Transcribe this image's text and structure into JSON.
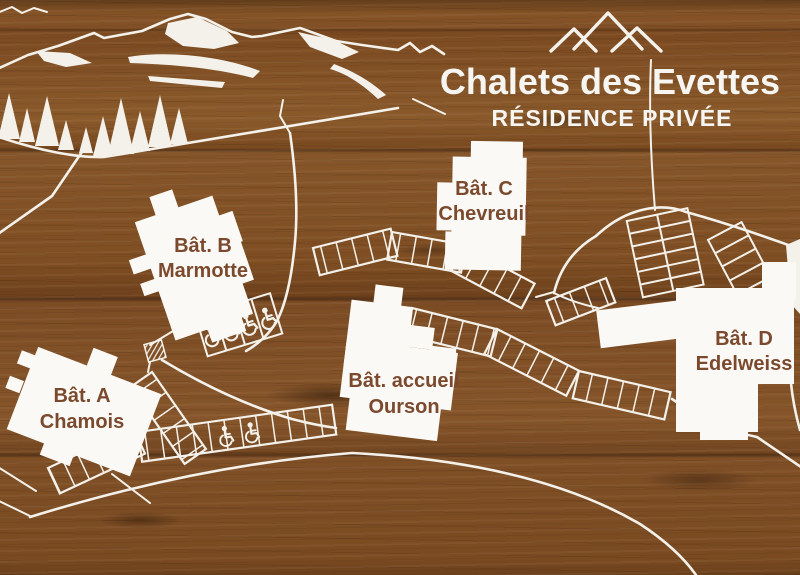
{
  "sign": {
    "title": "Chalets des Evettes",
    "subtitle": "RÉSIDENCE PRIVÉE"
  },
  "buildings": [
    {
      "code": "Bât. A",
      "name": "Chamois"
    },
    {
      "code": "Bât. B",
      "name": "Marmotte"
    },
    {
      "code": "Bât. C",
      "name": "Chevreuil"
    },
    {
      "code": "Bât. D",
      "name": "Edelweiss"
    },
    {
      "code": "Bât. accueil",
      "name": "Ourson"
    }
  ],
  "icons": {
    "peaks": "three-peak-mountain-outline",
    "wheelchair": "accessible-parking-symbol",
    "trees": "pine-tree-silhouettes",
    "ridge": "mountain-ridge-with-snow"
  },
  "map_features": {
    "accessible_spaces_near_bat_b": 4,
    "accessible_spaces_lower_lot": 2
  },
  "colors": {
    "wood_base": "#7d4a22",
    "artwork_white": "#f4f1ea",
    "label_brown": "#7b4a2e"
  }
}
